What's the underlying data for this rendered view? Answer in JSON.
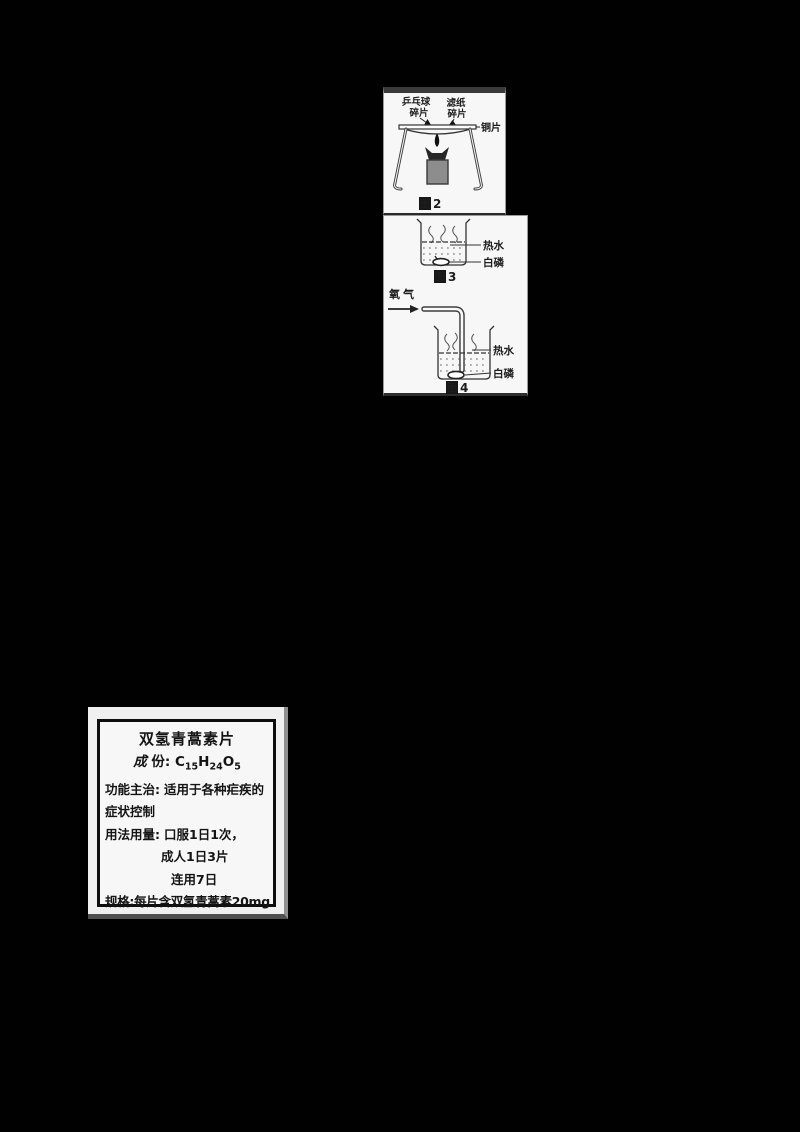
{
  "colors": {
    "page_background": "#000000",
    "paper": "#f7f7f7",
    "ink": "#1a1a1a",
    "lamp_body_gray": "#8d8d8d"
  },
  "figures": {
    "fig2": {
      "caption": {
        "prefix": "图",
        "number": "2"
      },
      "labels": {
        "pingpong_line1": "乒乓球",
        "pingpong_line2": "碎片",
        "filter_line1": "滤纸",
        "filter_line2": "碎片",
        "copper_sheet": "铜片"
      }
    },
    "fig3": {
      "caption": {
        "prefix": "图",
        "number": "3"
      },
      "labels": {
        "hot_water": "热水",
        "white_phosphorus": "白磷"
      }
    },
    "fig4": {
      "caption": {
        "prefix": "图",
        "number": "4"
      },
      "labels": {
        "oxygen": "氧气",
        "hot_water": "热水",
        "white_phosphorus": "白磷"
      }
    }
  },
  "medicine_label": {
    "title": "双氢青蒿素片",
    "composition": {
      "label_script": "成",
      "label_rest": "份:",
      "f1": "C",
      "f1_sub": "15",
      "f2": "H",
      "f2_sub": "24",
      "f3": "O",
      "f3_sub": "5"
    },
    "indication_label": "功能主治:",
    "indication_text": "适用于各种疟疾的",
    "indication_text2": "症状控制",
    "usage_label": "用法用量:",
    "usage_line1": "口服1日1次，",
    "usage_line2": "成人1日3片",
    "usage_line3": "连用7日",
    "spec_label": "规格:",
    "spec_text": "每片含双氢青蒿素",
    "spec_amount": "20mg"
  }
}
